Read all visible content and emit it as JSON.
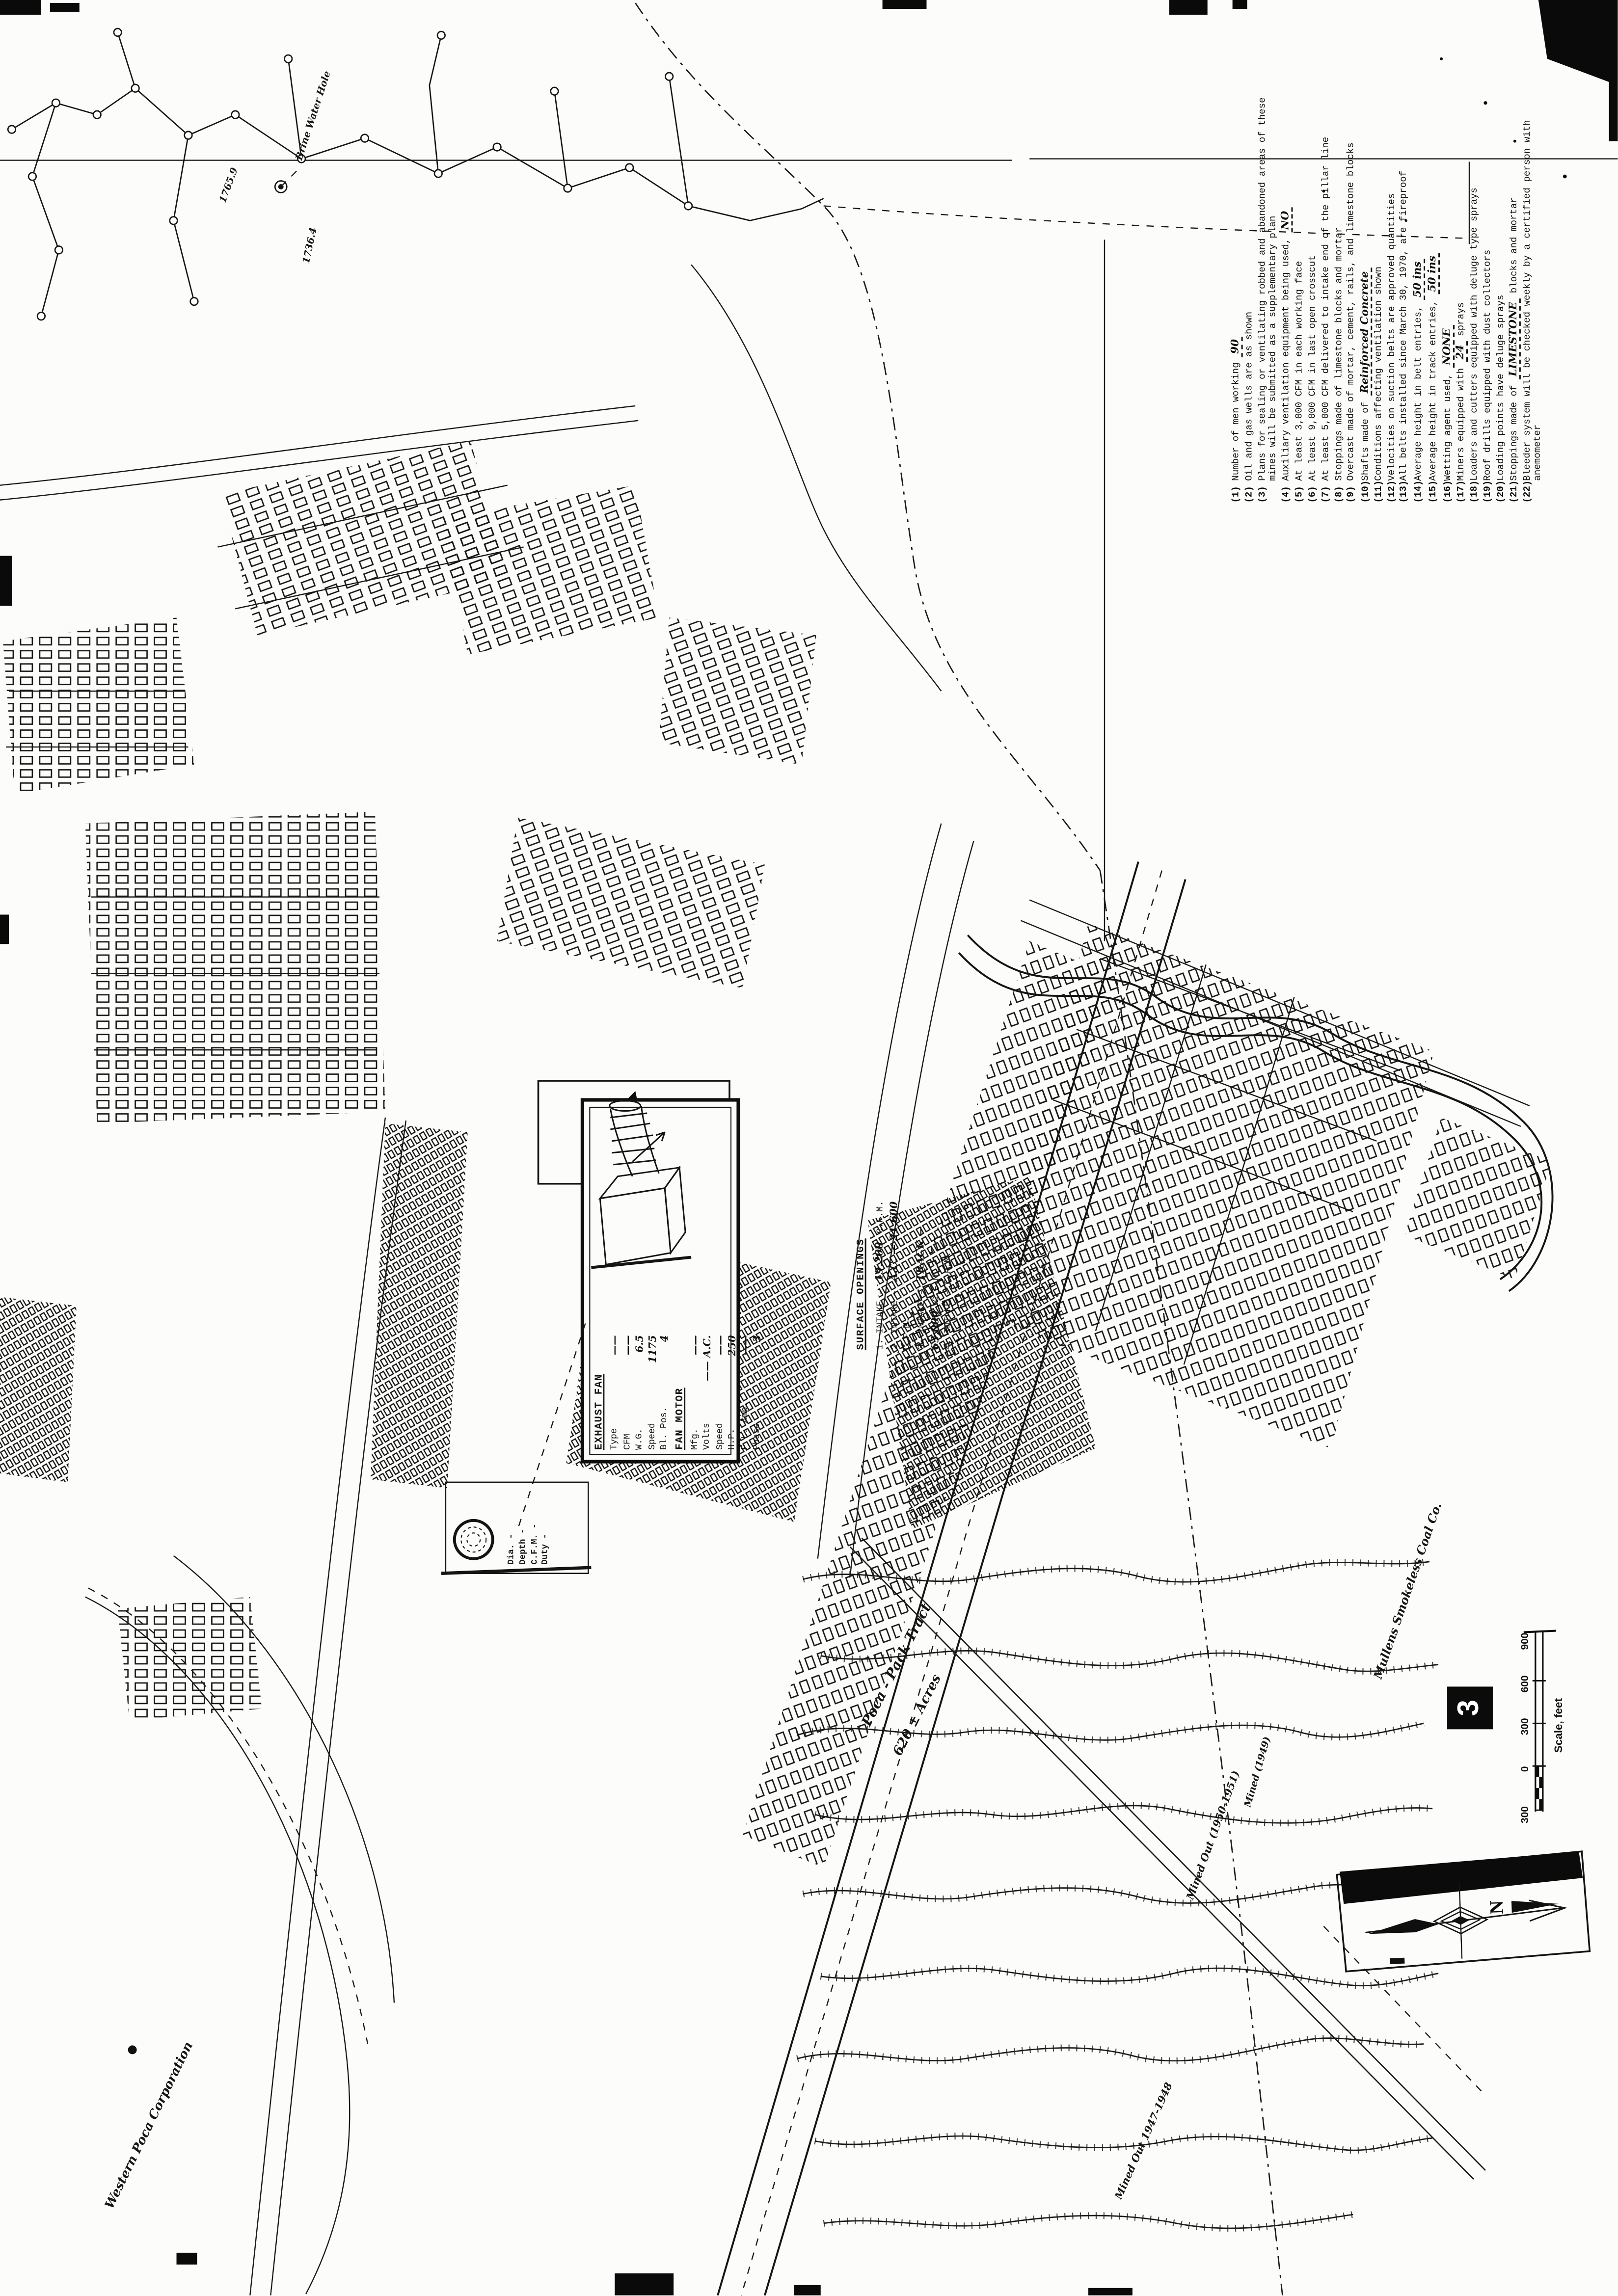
{
  "sheet": {
    "number": "3"
  },
  "notes": {
    "items": [
      {
        "num": "(1)",
        "pre": "Number of men working",
        "fill": "90",
        "post": ""
      },
      {
        "num": "(2)",
        "pre": "Oil and gas wells are as shown",
        "fill": "",
        "post": ""
      },
      {
        "num": "(3)",
        "pre": "Plans for sealing or ventilating robbed and abandoned areas of these mines will be submitted as a supplementary plan",
        "fill": "",
        "post": ""
      },
      {
        "num": "(4)",
        "pre": "Auxiliary ventilation equipment being used,",
        "fill": "NO",
        "post": ""
      },
      {
        "num": "(5)",
        "pre": "At least 3,000 CFM in each working face",
        "fill": "",
        "post": ""
      },
      {
        "num": "(6)",
        "pre": "At least 9,000 CFM in last open crosscut",
        "fill": "",
        "post": ""
      },
      {
        "num": "(7)",
        "pre": "At least 5,000 CFM delivered to intake end of the pillar line",
        "fill": "",
        "post": ""
      },
      {
        "num": "(8)",
        "pre": "Stoppings made of limestone blocks and mortar",
        "fill": "",
        "post": ""
      },
      {
        "num": "(9)",
        "pre": "Overcast made of mortar, cement, rails, and limestone blocks",
        "fill": "",
        "post": ""
      },
      {
        "num": "(10)",
        "pre": "Shafts made of",
        "fill": "Reinforced Concrete",
        "post": ""
      },
      {
        "num": "(11)",
        "pre": "Conditions affecting ventilation shown",
        "fill": "",
        "post": ""
      },
      {
        "num": "(12)",
        "pre": "Velocities on suction belts are approved quantities",
        "fill": "",
        "post": ""
      },
      {
        "num": "(13)",
        "pre": "All belts installed since March 30, 1970, are fireproof",
        "fill": "",
        "post": ""
      },
      {
        "num": "(14)",
        "pre": "Average height in belt entries,",
        "fill": "50 ins",
        "post": ""
      },
      {
        "num": "(15)",
        "pre": "Average height in track entries,",
        "fill": "50 ins",
        "post": ""
      },
      {
        "num": "(16)",
        "pre": "Wetting agent used,",
        "fill": "NONE",
        "post": ""
      },
      {
        "num": "(17)",
        "pre": "Miners equipped with",
        "fill": "24",
        "post": "sprays"
      },
      {
        "num": "(18)",
        "pre": "Loaders and cutters equipped with deluge type sprays",
        "fill": "",
        "post": ""
      },
      {
        "num": "(19)",
        "pre": "Roof drills equipped with dust collectors",
        "fill": "",
        "post": ""
      },
      {
        "num": "(20)",
        "pre": "Loading points have deluge sprays",
        "fill": "",
        "post": ""
      },
      {
        "num": "(21)",
        "pre": "Stoppings made of",
        "fill": "LIMESTONE",
        "post": "blocks and mortar"
      },
      {
        "num": "(22)",
        "pre": "Bleeder system will be checked weekly by a certified person with anemometer",
        "fill": "",
        "post": ""
      }
    ]
  },
  "fan": {
    "title": "EXHAUST FAN",
    "rows": [
      {
        "l": "Type",
        "v": "——"
      },
      {
        "l": "CFM",
        "v": "——"
      },
      {
        "l": "W.G.",
        "v": "6.5"
      },
      {
        "l": "Speed",
        "v": "1175"
      },
      {
        "l": "Bl. Pos.",
        "v": "4"
      }
    ],
    "motor_title": "FAN MOTOR",
    "motor_rows": [
      {
        "l": "Mfg.",
        "v": "——"
      },
      {
        "l": "Volts",
        "v": "—— A.C."
      },
      {
        "l": "Speed",
        "v": "——"
      },
      {
        "l": "H.P.",
        "v": "250"
      },
      {
        "l": "F.L. Amp.",
        "v": "——"
      },
      {
        "l": "Phase",
        "v": "3"
      }
    ]
  },
  "surface_openings": {
    "title": "SURFACE OPENINGS",
    "rows": [
      {
        "pre": "1. INTAKE -",
        "fill": "19,200",
        "post": "C.F.M."
      },
      {
        "pre": "2. INTAKE -",
        "fill": "A.C. — 21,600",
        "post": "C.F.M."
      },
      {
        "pre": "3. INTAKE -",
        "fill": "TRACK — 63,000",
        "post": "C.F.M."
      },
      {
        "pre": "4. INTAKE -",
        "fill": "",
        "post": "C.F.M."
      }
    ]
  },
  "shaft": {
    "rows": [
      {
        "l": "Dia. -"
      },
      {
        "l": "Depth -"
      },
      {
        "l": "C.F.M. -"
      },
      {
        "l": "Duty -"
      }
    ]
  },
  "scale": {
    "t900": "900",
    "t600": "600",
    "t300a": "300",
    "t0": "0",
    "t300b": "300",
    "caption": "Scale, feet"
  },
  "compass": {
    "letter": "N"
  },
  "labels": {
    "tract1": "Poca - Pack Tract",
    "tract2": "620 ± Acres",
    "mullens": "Mullens Smokeless Coal Co.",
    "western": "Western Poca Corporation",
    "mined1": "Mined Out (1950-1951)",
    "mined2": "Mined Out 1947-1948",
    "mined3": "Mined (1949)",
    "well1": "1736.4",
    "well2": "1765.9",
    "brine": "Brine Water Hole"
  }
}
